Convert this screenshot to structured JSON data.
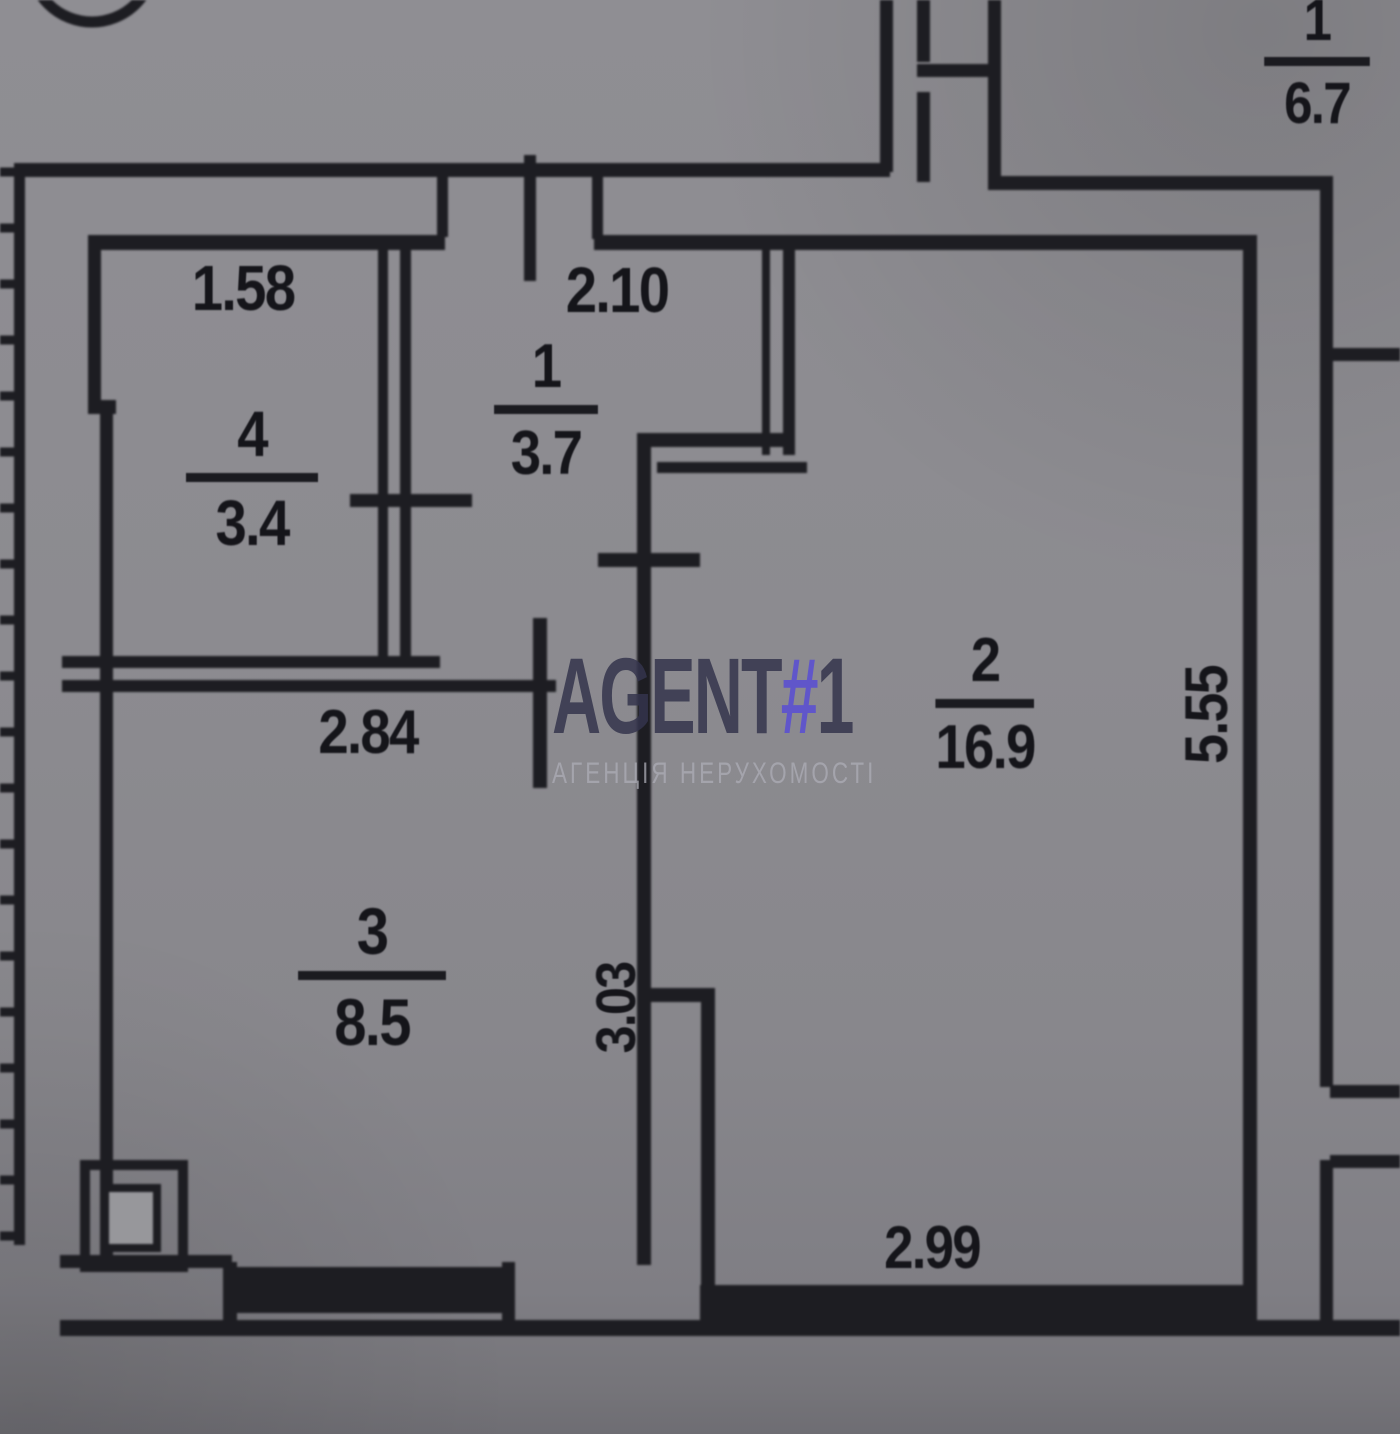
{
  "document_type": "apartment floor plan (BTI technical drawing photo)",
  "watermark": {
    "brand": "AGENT",
    "hash": "#",
    "number": "1",
    "subtitle": "АГЕНЦІЯ НЕРУХОМОСТІ"
  },
  "rooms": [
    {
      "number": "1",
      "area": "3.7"
    },
    {
      "number": "2",
      "area": "16.9"
    },
    {
      "number": "3",
      "area": "8.5"
    },
    {
      "number": "4",
      "area": "3.4"
    },
    {
      "number": "1",
      "area": "6.7"
    }
  ],
  "dims": {
    "d158": "1.58",
    "d210": "2.10",
    "d284": "2.84",
    "d303": "3.03",
    "d555": "5.55",
    "d299": "2.99"
  },
  "colors": {
    "background": "#8c8b90",
    "line": "#1d1d22",
    "watermark_text": "#34344c",
    "watermark_hash": "#5e53cd",
    "watermark_subtitle": "#acacb6"
  }
}
